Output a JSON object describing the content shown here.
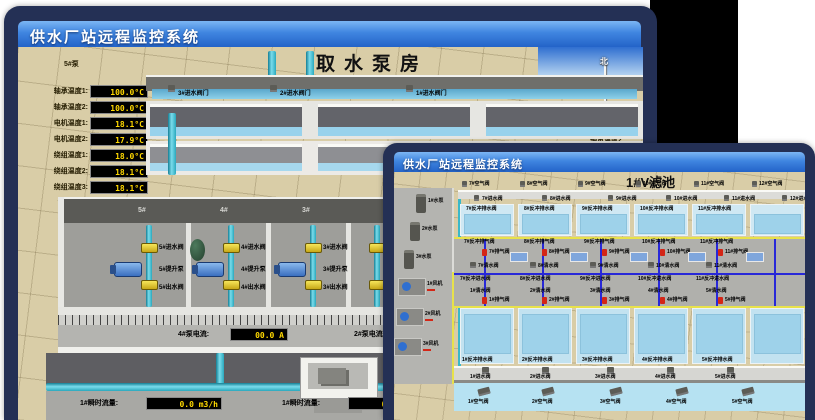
{
  "back_window": {
    "title": "供水厂站远程监控系统",
    "scene_title": "取水泵房",
    "compass": {
      "north": "北",
      "west": "西",
      "south": "南"
    },
    "pump_panel": {
      "header": "5#泵",
      "rows": [
        {
          "label": "轴承温度1:",
          "value": "100.0°C"
        },
        {
          "label": "轴承温度2:",
          "value": "100.0°C"
        },
        {
          "label": "电机温度1:",
          "value": "18.1°C"
        },
        {
          "label": "电机温度2:",
          "value": "17.9°C"
        },
        {
          "label": "绕组温度1:",
          "value": "18.0°C"
        },
        {
          "label": "绕组温度2:",
          "value": "18.1°C"
        },
        {
          "label": "绕组温度3:",
          "value": "18.1°C"
        },
        {
          "label": "管道压力:",
          "value": "0.0007MPa"
        },
        {
          "label": "多功能阀:",
          "value": "0%"
        }
      ]
    },
    "right_partial_labels": [
      "轴承温度1",
      "轴承温度2"
    ],
    "inlet_gate_valves": [
      "3#进水阀门",
      "2#进水阀门",
      "1#进水阀门"
    ],
    "bay_numbers": [
      "5#",
      "4#",
      "3#"
    ],
    "bays": [
      {
        "inlet": "5#进水阀",
        "pump": "5#提升泵",
        "outlet": "5#出水阀"
      },
      {
        "inlet": "4#进水阀",
        "pump": "4#提升泵",
        "outlet": "4#出水阀"
      },
      {
        "inlet": "3#进水阀",
        "pump": "3#提升泵",
        "outlet": "3#出水阀"
      }
    ],
    "current_readouts": [
      {
        "label": "4#泵电流:",
        "value": "00.0 A"
      },
      {
        "label": "2#泵电流:",
        "value": ""
      }
    ],
    "flow_readouts": [
      {
        "label": "1#瞬时流量:",
        "value": "0.0 m3/h"
      },
      {
        "label": "1#瞬时流量:",
        "value": "0.0 m3/h"
      }
    ]
  },
  "front_window": {
    "title": "供水厂站远程监控系统",
    "scene_title": "1#V滤池",
    "equipment": [
      "1#水泵",
      "2#水泵",
      "3#水泵",
      "1#风机",
      "2#风机",
      "3#风机"
    ],
    "air_valves_top": [
      "7#空气阀",
      "8#空气阀",
      "9#空气阀",
      "10#空气阀",
      "11#空气阀",
      "12#空气阀"
    ],
    "inlet_valves_top": [
      "7#进水阀",
      "8#进水阀",
      "9#进水阀",
      "10#进水阀",
      "11#进水阀",
      "12#进水阀"
    ],
    "backwash_drain_top": [
      "7#反冲排水阀",
      "8#反冲排水阀",
      "9#反冲排水阀",
      "10#反冲排水阀",
      "11#反冲排水阀"
    ],
    "backwash_exhaust_valves": [
      "7#反冲排气阀",
      "8#反冲排气阀",
      "9#反冲排气阀",
      "10#反冲排气阀",
      "11#反冲排气阀"
    ],
    "exhaust_valves": [
      "7#排气阀",
      "8#排气阀",
      "9#排气阀",
      "10#排气阀",
      "11#排气阀"
    ],
    "clean_water_valves": [
      "7#清水阀",
      "8#清水阀",
      "9#清水阀",
      "10#清水阀",
      "11#清水阀"
    ],
    "backwash_inlet_valves": [
      "7#反冲进水阀",
      "8#反冲进水阀",
      "9#反冲进水阀",
      "10#反冲进水阀",
      "11#反冲进水阀"
    ],
    "clean_water_lower": [
      "1#清水阀",
      "2#清水阀",
      "3#清水阀",
      "4#清水阀",
      "5#清水阀"
    ],
    "exhaust_lower": [
      "1#排气阀",
      "2#排气阀",
      "3#排气阀",
      "4#排气阀",
      "5#排气阀"
    ],
    "backwash_drain_bottom": [
      "1#反冲排水阀",
      "2#反冲排水阀",
      "3#反冲排水阀",
      "4#反冲排水阀",
      "5#反冲排水阀"
    ],
    "inlet_valves_bottom": [
      "1#进水阀",
      "2#进水阀",
      "3#进水阀",
      "4#进水阀",
      "5#进水阀"
    ],
    "air_valves_bottom": [
      "1#空气阀",
      "2#空气阀",
      "3#空气阀",
      "4#空气阀",
      "5#空气阀"
    ]
  },
  "colors": {
    "window_frame": "#243055",
    "titlebar_top": "#5aa0ec",
    "titlebar_bottom": "#2363c8",
    "readout_value": "#ffd800",
    "floor_tan": "#d9cda7",
    "pipe_teal": "#3ab8c8",
    "pipe_yellow": "#e8e24a",
    "pipe_blue": "#2828d8"
  }
}
